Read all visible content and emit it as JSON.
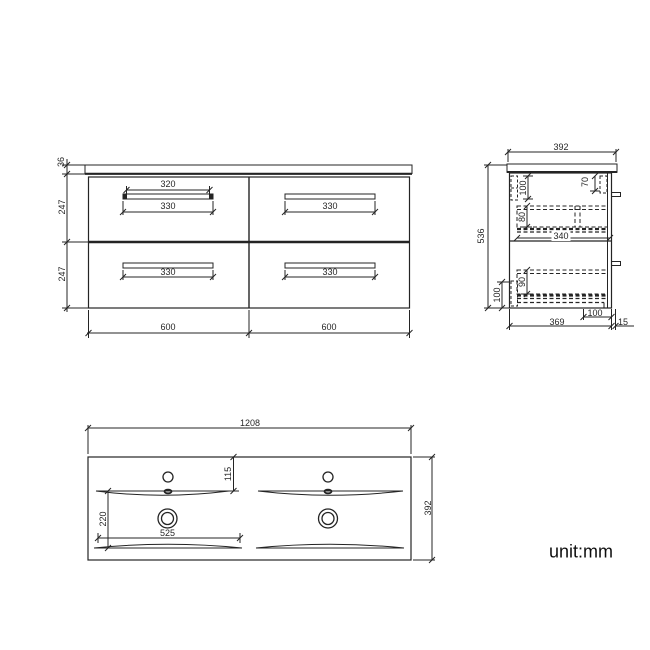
{
  "unit_label": "unit:mm",
  "colors": {
    "line": "#242424",
    "text": "#262626",
    "background": "#ffffff"
  },
  "front_view": {
    "title": "front-elevation",
    "dims": {
      "counter_thickness": "36",
      "row_upper": "247",
      "row_lower": "247",
      "handle_inner_tl": "320",
      "handle_tl": "330",
      "handle_tr": "330",
      "handle_bl": "330",
      "handle_br": "330",
      "width_left": "600",
      "width_right": "600"
    }
  },
  "side_view": {
    "title": "side-section",
    "dims": {
      "depth_top": "392",
      "height": "536",
      "slide_left": "100",
      "slide_right": "70",
      "drawer_upper": "80",
      "drawer_depth": "340",
      "drawer_lower": "90",
      "plinth_left": "100",
      "recess_bottom": "100",
      "base_depth": "369",
      "back_gap": "15"
    }
  },
  "plan_view": {
    "title": "basin-plan",
    "dims": {
      "width": "1208",
      "depth": "392",
      "tap_setback": "115",
      "bowl_depth": "220",
      "bowl_width": "525"
    }
  }
}
